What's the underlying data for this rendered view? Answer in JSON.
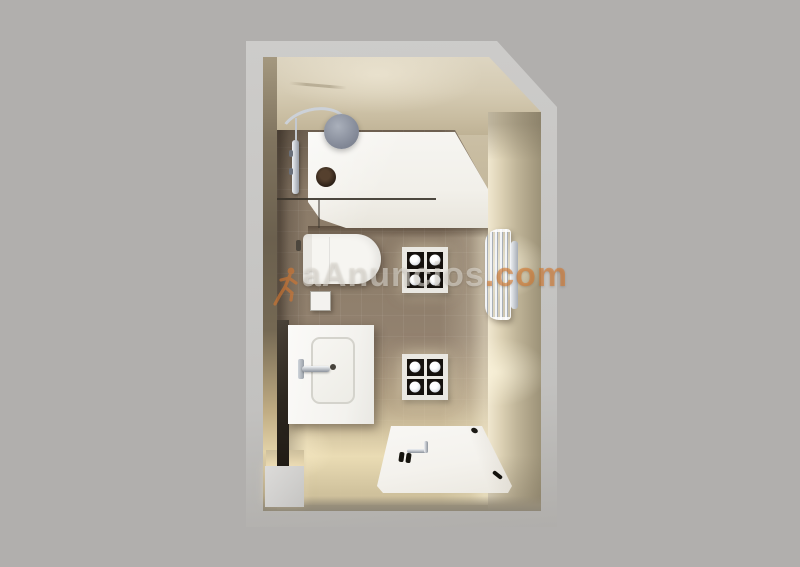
{
  "watermark": {
    "icon": "running-person-icon",
    "brand": "aAnuncios",
    "tld": ".com"
  },
  "colors": {
    "background": "#b1afad",
    "outer_wall": "#c7c6c4",
    "wall_beige_light": "#ddd5c1",
    "wall_beige_dark": "#6b604e",
    "floor_tile": "#8e7e6b",
    "floor_glow": "#eadcb4",
    "fixture_white": "#f6f5f1",
    "chrome": "#a9afb7",
    "spotlight_black": "#15110d",
    "watermark_brand": "#e3e0d98c",
    "watermark_tld": "#d7792e99"
  },
  "scene": {
    "view": "top-down 3D render of a small bathroom",
    "fixtures": [
      "shower-tray",
      "shower-head",
      "shower-curtain-rail",
      "shower-column",
      "floor-drain",
      "glass-partition",
      "toilet",
      "storage-box",
      "vanity-washbasin",
      "basin-faucet",
      "spotlight-panel-upper",
      "spotlight-panel-lower",
      "towel-radiator",
      "bathtub",
      "wall-notch"
    ]
  }
}
